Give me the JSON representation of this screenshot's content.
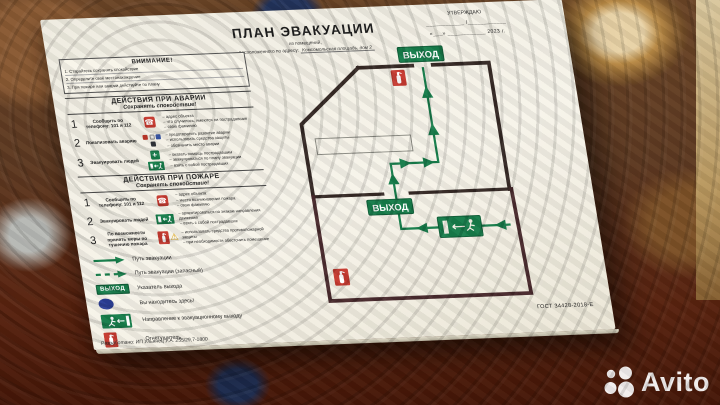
{
  "watermark": {
    "brand": "Avito"
  },
  "plate": {
    "approval": {
      "title": "УТВЕРЖДАЮ",
      "line2": "____________ /____________",
      "line3": "«___» ____________ 2023 г."
    },
    "title": "ПЛАН ЭВАКУАЦИИ",
    "subtitle_line1": "из помещений,",
    "subtitle_line2_prefix": "расположенного по адресу:",
    "subtitle_line2_value": "Комсомольская площадь, дом 2",
    "attention": {
      "title": "ВНИМАНИЕ!",
      "items": [
        "1. Старайтесь сохранять спокойствие",
        "2. Определите своё местонахождение",
        "3. При пожаре или аварии действуйте по плану"
      ]
    },
    "accident": {
      "title": "ДЕЙСТВИЯ ПРИ АВАРИИ",
      "subtitle": "Сохранять спокойствие!",
      "steps": [
        {
          "num": "1",
          "label": "Сообщить по телефону: 101 и 112",
          "notes": [
            "– адрес объекта",
            "– что случилось, имеются ли пострадавшие",
            "– свою фамилию"
          ]
        },
        {
          "num": "2",
          "label": "Локализовать аварию",
          "notes": [
            "– предотвратить развитие аварии",
            "– использовать средства защиты",
            "– обозначить место аварии"
          ]
        },
        {
          "num": "3",
          "label": "Эвакуировать людей",
          "notes": [
            "– оказать помощь пострадавшим",
            "– эвакуироваться по плану эвакуации",
            "– взять с собой пострадавших"
          ]
        }
      ]
    },
    "fire": {
      "title": "ДЕЙСТВИЯ ПРИ ПОЖАРЕ",
      "subtitle": "Сохранять спокойствие!",
      "steps": [
        {
          "num": "1",
          "label": "Сообщить по телефону: 101 и 112",
          "notes": [
            "– адрес объекта",
            "– место возникновения пожара",
            "– свою фамилию"
          ]
        },
        {
          "num": "2",
          "label": "Эвакуировать людей",
          "notes": [
            "– ориентироваться по знакам направления движения",
            "– взять с собой пострадавших"
          ]
        },
        {
          "num": "3",
          "label": "По возможности принять меры по тушению пожара",
          "notes": [
            "– использовать средства противопожарной защиты",
            "– при необходимости обесточить помещение"
          ]
        }
      ]
    },
    "legend": {
      "items": [
        {
          "icon": "evac-path-solid-arrow",
          "label": "Путь эвакуации"
        },
        {
          "icon": "evac-path-dashed-arrow",
          "label": "Путь эвакуации (запасный)"
        },
        {
          "icon": "exit-sign",
          "label": "Указатель выхода"
        },
        {
          "icon": "you-are-here-dot",
          "label": "Вы находитесь здесь!"
        },
        {
          "icon": "exit-man-sign",
          "label": "Направление к эвакуационному выходу"
        },
        {
          "icon": "fire-extinguisher-sign",
          "label": "Огнетушитель"
        }
      ]
    },
    "plan": {
      "exit_label": "ВЫХОД"
    },
    "gost": "ГОСТ 34428-2018-Е",
    "developer": "Разработано: ИП Ульянец У.А. 255/29,7-1800",
    "colors": {
      "green": "#177d4b",
      "red": "#c63a30",
      "blue": "#2c3f97",
      "wall": "#362a26",
      "wall_lower": "#4a2b2e"
    }
  }
}
